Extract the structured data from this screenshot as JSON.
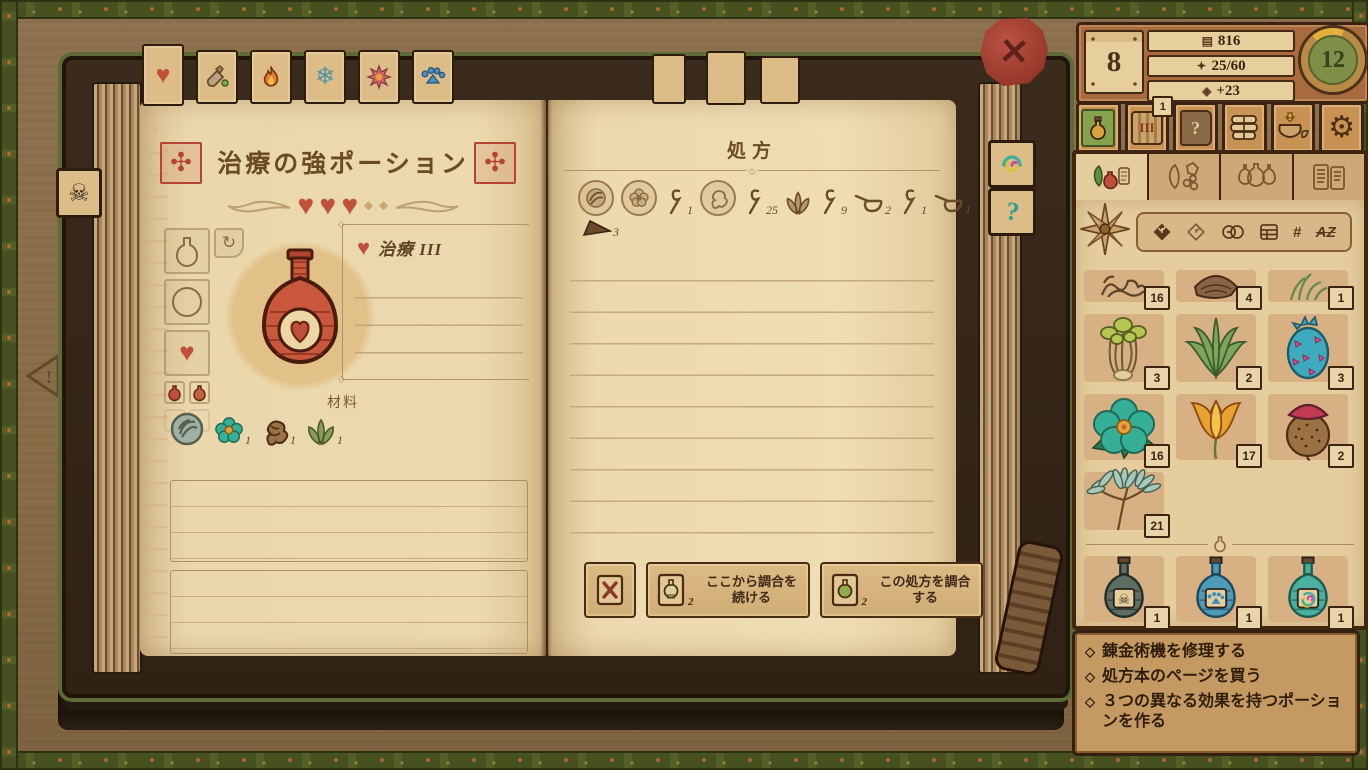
{
  "theme": {
    "accent": "#c0503a",
    "wood": "#8d7049",
    "page": "#e8d3a8",
    "sidebar_orange": "#b5703f",
    "frame_dark": "#33200e",
    "trim_green": "#5d6b37",
    "gold": "#e2b13c",
    "level_green": "#7e9048"
  },
  "stats": {
    "day": "8",
    "money": "816",
    "experience": "25/60",
    "popularity": "+23",
    "level": "12"
  },
  "toolbar": {
    "basement_badge": "1",
    "barrel_label": "III",
    "question_label": "?"
  },
  "book": {
    "left_page": {
      "title": "治療の強ポーション",
      "effect_label": "治療 III",
      "materials_label": "材料",
      "material_counts": [
        "1",
        "1",
        "1"
      ]
    },
    "right_page": {
      "title": "処方",
      "step_counts": {
        "stir1": "1",
        "stir2": "25",
        "stir3": "9",
        "ladle1": "2",
        "stir4": "1",
        "ladle2": "1",
        "grind": "3"
      },
      "continue_button": "ここから調合を続ける",
      "brew_button": "この処方を調合する",
      "continue_sub": "2",
      "brew_sub": "2"
    }
  },
  "sidebar": {
    "ingredients": [
      {
        "name": "star-anise",
        "count": ""
      },
      {
        "name": "tangle-roots",
        "count": "16"
      },
      {
        "name": "waterbloom",
        "count": "4"
      },
      {
        "name": "green-herb",
        "count": "1"
      },
      {
        "name": "green-mushrooms",
        "count": "3"
      },
      {
        "name": "aloe-leaf",
        "count": "2"
      },
      {
        "name": "dragonfruit",
        "count": "3"
      },
      {
        "name": "teal-flower",
        "count": "16"
      },
      {
        "name": "orange-flower",
        "count": "17"
      },
      {
        "name": "red-mushroom",
        "count": "2"
      },
      {
        "name": "teal-bunch",
        "count": "21"
      }
    ],
    "potions": [
      {
        "name": "poison-potion",
        "count": "1"
      },
      {
        "name": "paw-potion",
        "count": "1"
      },
      {
        "name": "rainbow-potion",
        "count": "1"
      }
    ],
    "goal_bullet": "◇",
    "goals": [
      "錬金術機を修理する",
      "処方本のページを買う",
      "３つの異なる効果を持つポーションを作る"
    ]
  },
  "icons": {
    "heart": "♥",
    "snowflake": "❄",
    "skull": "☠",
    "gear": "⚙",
    "close": "✕",
    "refresh": "↻",
    "question": "?",
    "exp_star": "✦",
    "money": "▤",
    "gem": "◈",
    "slot_diamond": "◆",
    "divider_diamond": "◇",
    "stamp": "✣",
    "minus": "−",
    "plus": "+",
    "hash": "#",
    "az": "AZ"
  }
}
